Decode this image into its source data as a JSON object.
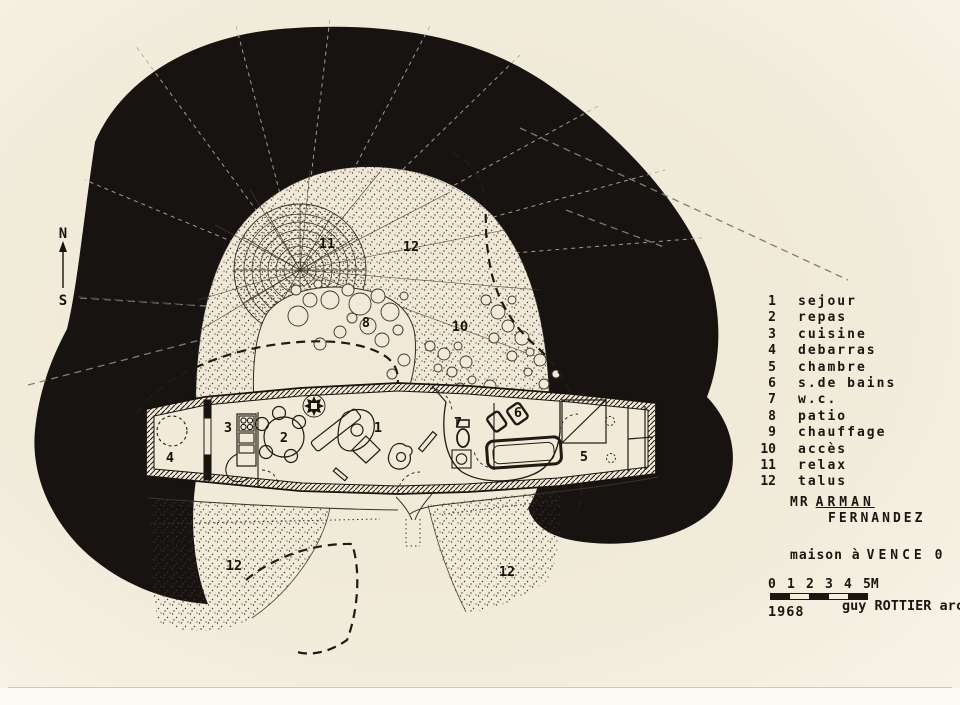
{
  "compass": {
    "north": "N",
    "south": "S"
  },
  "legend": {
    "items": [
      {
        "num": "1",
        "label": "sejour"
      },
      {
        "num": "2",
        "label": "repas"
      },
      {
        "num": "3",
        "label": "cuisine"
      },
      {
        "num": "4",
        "label": "debarras"
      },
      {
        "num": "5",
        "label": "chambre"
      },
      {
        "num": "6",
        "label": "s.de bains"
      },
      {
        "num": "7",
        "label": "w.c."
      },
      {
        "num": "8",
        "label": "patio"
      },
      {
        "num": "9",
        "label": "chauffage"
      },
      {
        "num": "10",
        "label": "accès"
      },
      {
        "num": "11",
        "label": "relax"
      },
      {
        "num": "12",
        "label": "talus"
      }
    ]
  },
  "plan_labels": {
    "sejour": "1",
    "repas": "2",
    "cuisine": "3",
    "debarras": "4",
    "chambre": "5",
    "bains": "6",
    "wc": "7",
    "patio": "8",
    "acces": "10",
    "relax": "11",
    "talus": "12"
  },
  "title_block": {
    "mr": "MR",
    "client": "ARMAN",
    "client2": "FERNANDEZ",
    "project_pre": "maison à",
    "project_city": "VENCE",
    "project_suffix": "0"
  },
  "scale_bar": {
    "labels": [
      "0",
      "1",
      "2",
      "3",
      "4",
      "5M"
    ]
  },
  "credits": {
    "year": "1968",
    "architect": "guy ROTTIER arch"
  },
  "colors": {
    "paper": "#efe8d6",
    "ink": "#1b1611",
    "blob": "#171310",
    "stipple": "#3c362c"
  }
}
